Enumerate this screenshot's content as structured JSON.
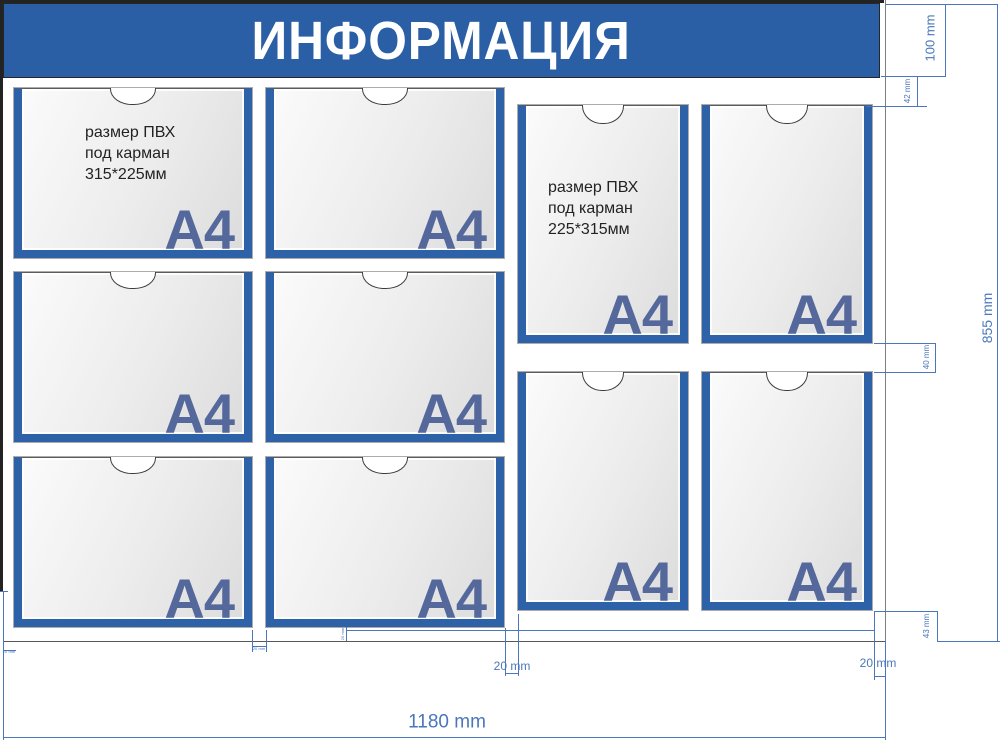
{
  "header": {
    "title": "ИНФОРМАЦИЯ"
  },
  "labels": {
    "a4": "A4"
  },
  "notes": {
    "landscape": "размер ПВХ\nпод карман\n315*225мм",
    "portrait": "размер ПВХ\nпод карман\n225*315мм"
  },
  "dimensions": {
    "header_height": "100 mm",
    "gap_header_to_pockets": "42 mm",
    "board_height": "855 mm",
    "gap_portrait_rows": "40 mm",
    "gap_bottom_right": "43 mm",
    "margin_right": "20 mm",
    "gap_mid_columns": "20 mm",
    "board_width": "1180 mm",
    "margin_left": "20 mm",
    "gap_landscape_columns": "20 mm",
    "gap_bottom_left": "20 mm"
  },
  "colors": {
    "header_blue": "#2b5fa5",
    "pocket_border_blue": "#2d62a8",
    "a4_label": "#55689b",
    "dimension_blue": "#4a77bb"
  }
}
